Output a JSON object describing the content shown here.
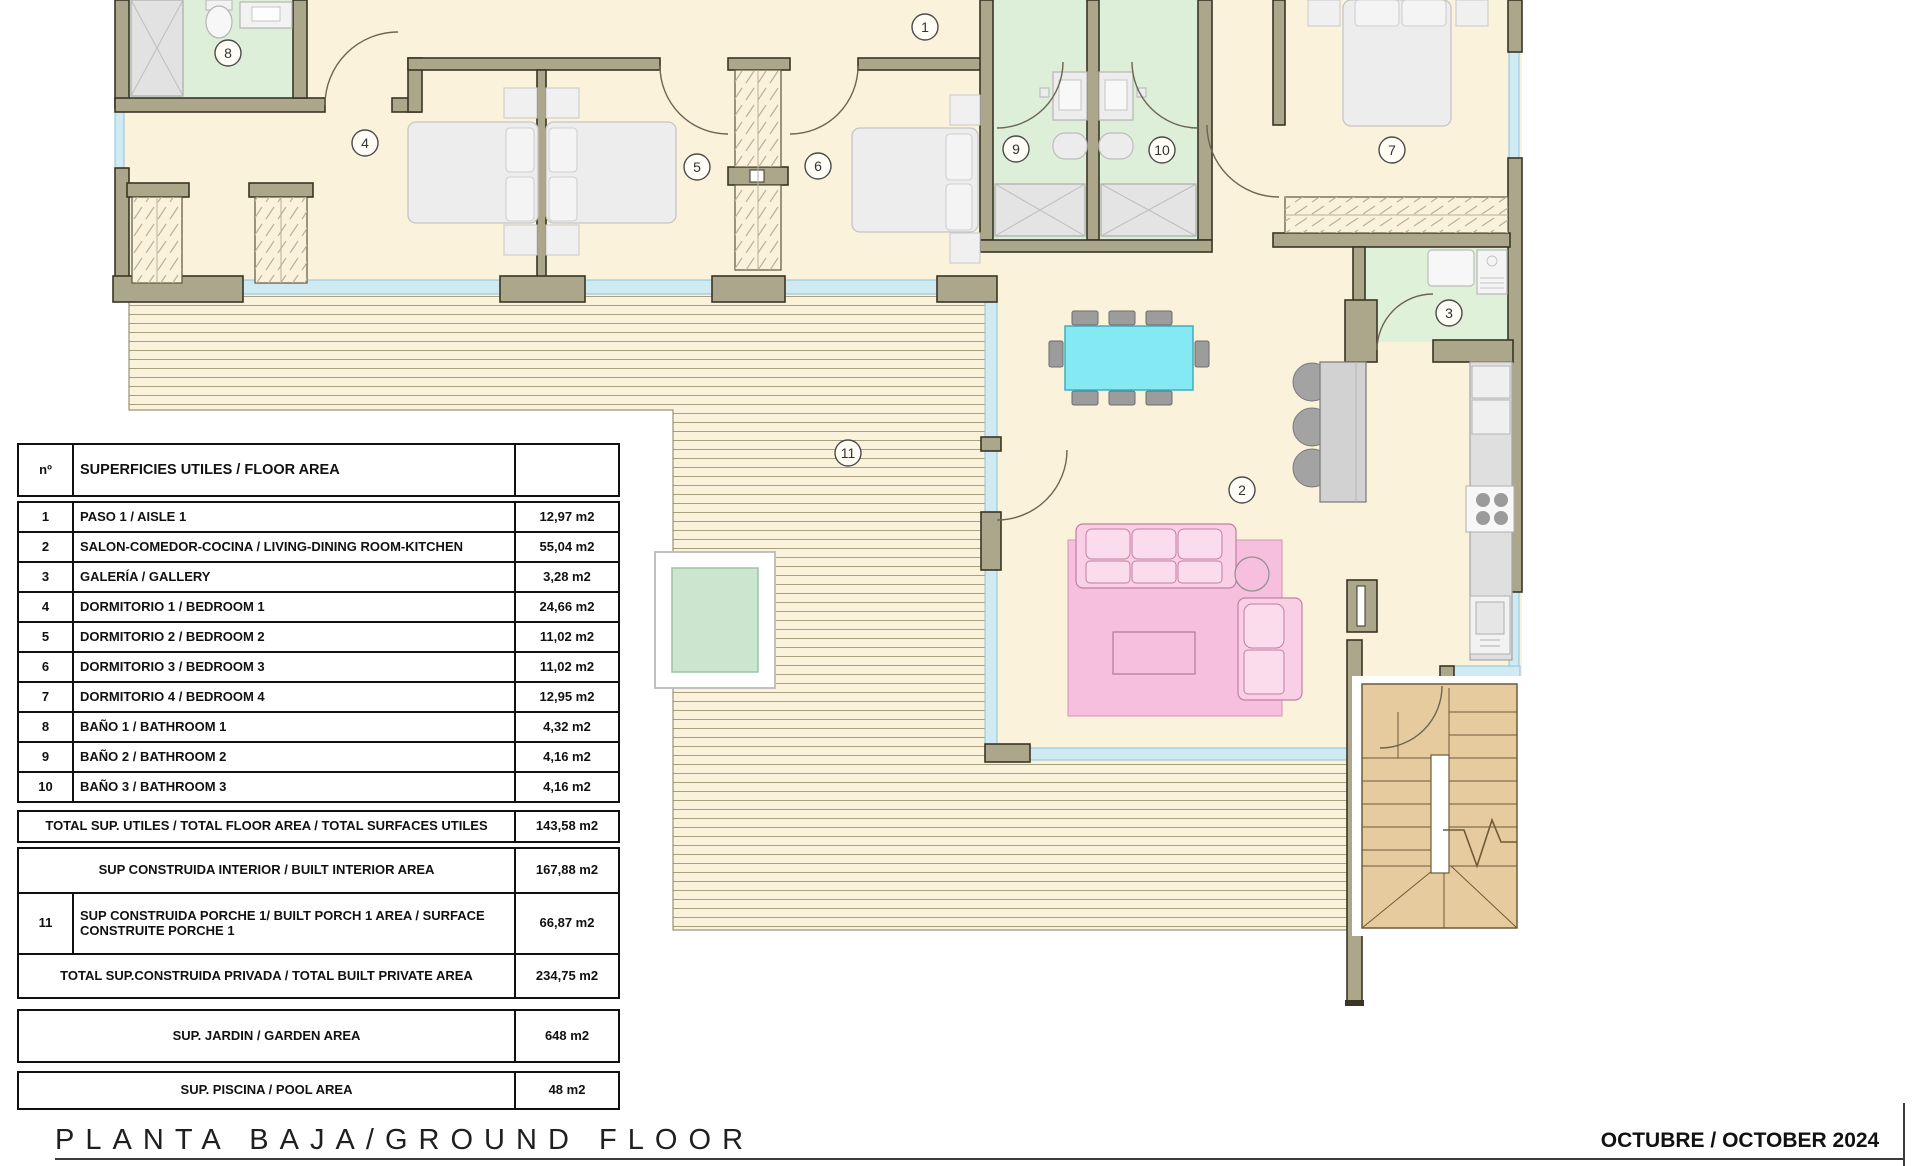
{
  "plan": {
    "markers": [
      "1",
      "2",
      "3",
      "4",
      "5",
      "6",
      "7",
      "8",
      "9",
      "10",
      "11"
    ]
  },
  "table": {
    "header": {
      "num": "nº",
      "label": "SUPERFICIES UTILES / FLOOR AREA",
      "value": ""
    },
    "rows": [
      {
        "n": "1",
        "label": "PASO 1 / AISLE 1",
        "value": "12,97 m2"
      },
      {
        "n": "2",
        "label": "SALON-COMEDOR-COCINA /  LIVING-DINING ROOM-KITCHEN",
        "value": "55,04 m2"
      },
      {
        "n": "3",
        "label": "GALERÍA / GALLERY",
        "value": "3,28 m2"
      },
      {
        "n": "4",
        "label": "DORMITORIO 1 / BEDROOM 1",
        "value": "24,66 m2"
      },
      {
        "n": "5",
        "label": "DORMITORIO 2 / BEDROOM 2",
        "value": "11,02 m2"
      },
      {
        "n": "6",
        "label": "DORMITORIO 3 / BEDROOM 3",
        "value": "11,02 m2"
      },
      {
        "n": "7",
        "label": "DORMITORIO 4 / BEDROOM 4",
        "value": "12,95 m2"
      },
      {
        "n": "8",
        "label": "BAÑO 1 / BATHROOM 1",
        "value": "4,32 m2"
      },
      {
        "n": "9",
        "label": "BAÑO 2 / BATHROOM 2",
        "value": "4,16 m2"
      },
      {
        "n": "10",
        "label": "BAÑO 3 / BATHROOM 3",
        "value": "4,16 m2"
      }
    ],
    "summary": [
      {
        "kind": "utiles",
        "n": "",
        "label": "TOTAL SUP. UTILES / TOTAL FLOOR AREA / TOTAL SURFACES UTILES",
        "value": "143,58 m2",
        "gap": 9
      },
      {
        "kind": "interior",
        "n": "",
        "label": "SUP CONSTRUIDA INTERIOR / BUILT INTERIOR AREA",
        "value": "167,88 m2",
        "gap": 6
      },
      {
        "kind": "porch",
        "n": "11",
        "label": "SUP CONSTRUIDA PORCHE 1/ BUILT PORCH 1 AREA / SURFACE CONSTRUITE PORCHE 1",
        "value": "66,87 m2",
        "gap": 0
      },
      {
        "kind": "privada",
        "n": "",
        "label": "TOTAL SUP.CONSTRUIDA PRIVADA / TOTAL  BUILT PRIVATE AREA",
        "value": "234,75 m2",
        "gap": 0
      },
      {
        "kind": "jardin",
        "n": "",
        "label": "SUP. JARDIN / GARDEN AREA",
        "value": "648 m2",
        "gap": 12
      },
      {
        "kind": "piscina",
        "n": "",
        "label": "SUP. PISCINA / POOL AREA",
        "value": "48 m2",
        "gap": 10
      }
    ]
  },
  "footer": {
    "title": "PLANTA BAJA/GROUND FLOOR",
    "date": "OCTUBRE / OCTOBER 2024"
  },
  "colors": {
    "floor": "#FBF2DC",
    "wall": "#ACA78B",
    "bath_green": "#DDEFD8",
    "window_blue": "#CFEAF2",
    "dining_cyan": "#84E9F2",
    "sofa_pink": "#F9CFE6",
    "rug_pink": "#F6BFDD",
    "stairs_tan": "#E6CB9F",
    "pool_green": "#CBE5CE"
  }
}
